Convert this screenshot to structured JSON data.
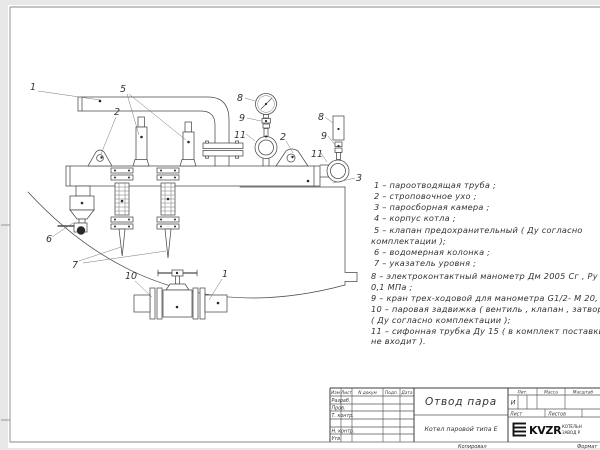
{
  "drawing_title": "Отвод пара",
  "callouts": [
    "1",
    "5",
    "2",
    "8",
    "9",
    "11",
    "2",
    "8",
    "9",
    "11",
    "3",
    "6",
    "7",
    "10",
    "1"
  ],
  "legend": {
    "lines": [
      "1 –  пароотводящая труба ;",
      "2 –  строповочное ухо ;",
      "3 –  паросборная камера ;",
      "4 –  корпус котла ;",
      "5 –  клапан предохранительный  ( Ду согласно",
      "комплектации );",
      "6 –  водомерная колонка ;",
      "7 – указатель уровня ;",
      "8 – электроконтактный манометр  Дм 2005 Сг ,  Ру",
      "0,1 МПа ;",
      "9 –  кран трех-ходовой для манометра  G1/2- М 20,",
      "10 –  паровая задвижка  ( вентиль , клапан , затвор",
      "( Ду согласно комплектации );",
      "11 –  сифонная трубка Ду 15 ( в комплект поставки",
      "не входит )."
    ]
  },
  "title_block": {
    "header_cols": [
      "Изм",
      "Лист",
      "N докум",
      "Подп.",
      "Дата"
    ],
    "rows": [
      "Разраб.",
      "Пров.",
      "Т. контр.",
      "Н. контр.",
      "Утв."
    ],
    "title": "Отвод пара",
    "product": "Котел паровой типа Е",
    "lit_label": "Лит.",
    "mass_label": "Масса",
    "scale_label": "Масштаб",
    "lit_value": "И",
    "sheet_label": "Лист",
    "sheets_label": "Листов",
    "logo": {
      "name": "KVZR",
      "sub1": "КОТЕЛЬН",
      "sub2": "ЗАВОД Р"
    },
    "footer_copy": "Копировал",
    "footer_format": "Формат"
  }
}
